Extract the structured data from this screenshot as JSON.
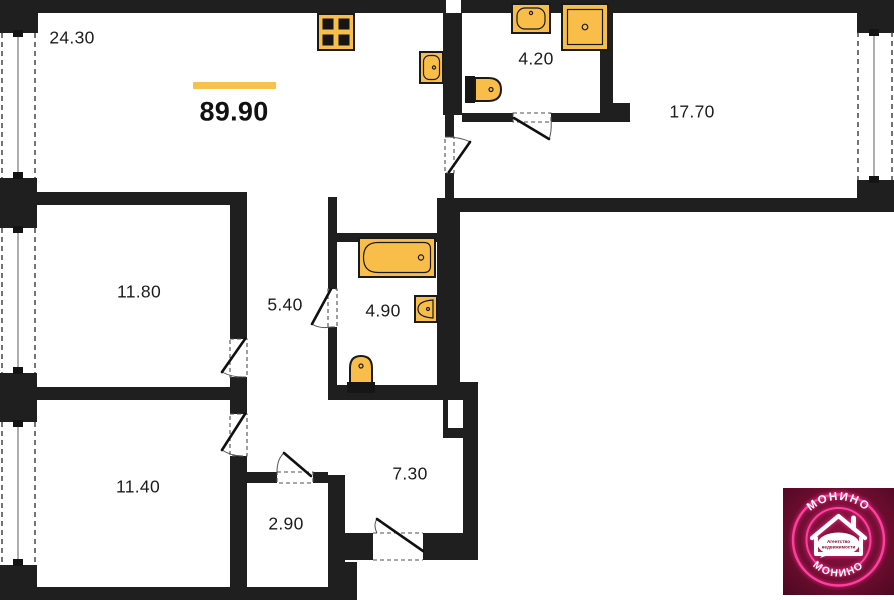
{
  "plan": {
    "total_area": "89.90",
    "rooms": [
      {
        "name": "kitchen-living-room",
        "area": "24.30"
      },
      {
        "name": "wc-small",
        "area": "4.20"
      },
      {
        "name": "room-right",
        "area": "17.70"
      },
      {
        "name": "bedroom-middle",
        "area": "11.80"
      },
      {
        "name": "hallway",
        "area": "5.40"
      },
      {
        "name": "bathroom-main",
        "area": "4.90"
      },
      {
        "name": "bedroom-bottom",
        "area": "11.40"
      },
      {
        "name": "storage",
        "area": "2.90"
      },
      {
        "name": "entry-hall",
        "area": "7.30"
      }
    ],
    "fixtures": [
      "stove",
      "kitchen-sink",
      "washbasin",
      "shower",
      "toilet",
      "bathtub",
      "washbasin",
      "toilet"
    ]
  },
  "colors": {
    "wall": "#1f1f1f",
    "fixture": "#F9BE4A",
    "accent_bar": "#F6C24E",
    "logo_background": "#6E0D30",
    "logo_neon": "#FF3FA0"
  },
  "logo": {
    "brand_top": "МОНИНО",
    "brand_bottom": "МОНИНО",
    "tagline_line1": "Агентство",
    "tagline_line2": "недвижимости"
  }
}
